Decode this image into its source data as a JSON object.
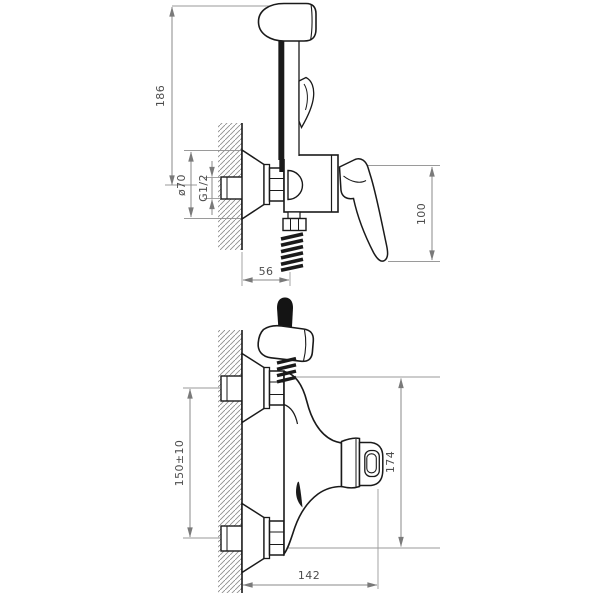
{
  "drawing": {
    "background_color": "#ffffff",
    "line_color": "#1a1a1a",
    "dimension_line_color": "#8a8a8a",
    "dimension_text_color": "#4d4d4d"
  },
  "views": {
    "top": {
      "dimensions": {
        "overall_height": "186",
        "flange_diameter": "ø70",
        "thread_size": "G1/2",
        "lever_height": "100",
        "wall_offset": "56"
      }
    },
    "bottom": {
      "dimensions": {
        "pipe_spacing": "150±10",
        "body_height": "174",
        "overall_width": "142"
      }
    }
  }
}
